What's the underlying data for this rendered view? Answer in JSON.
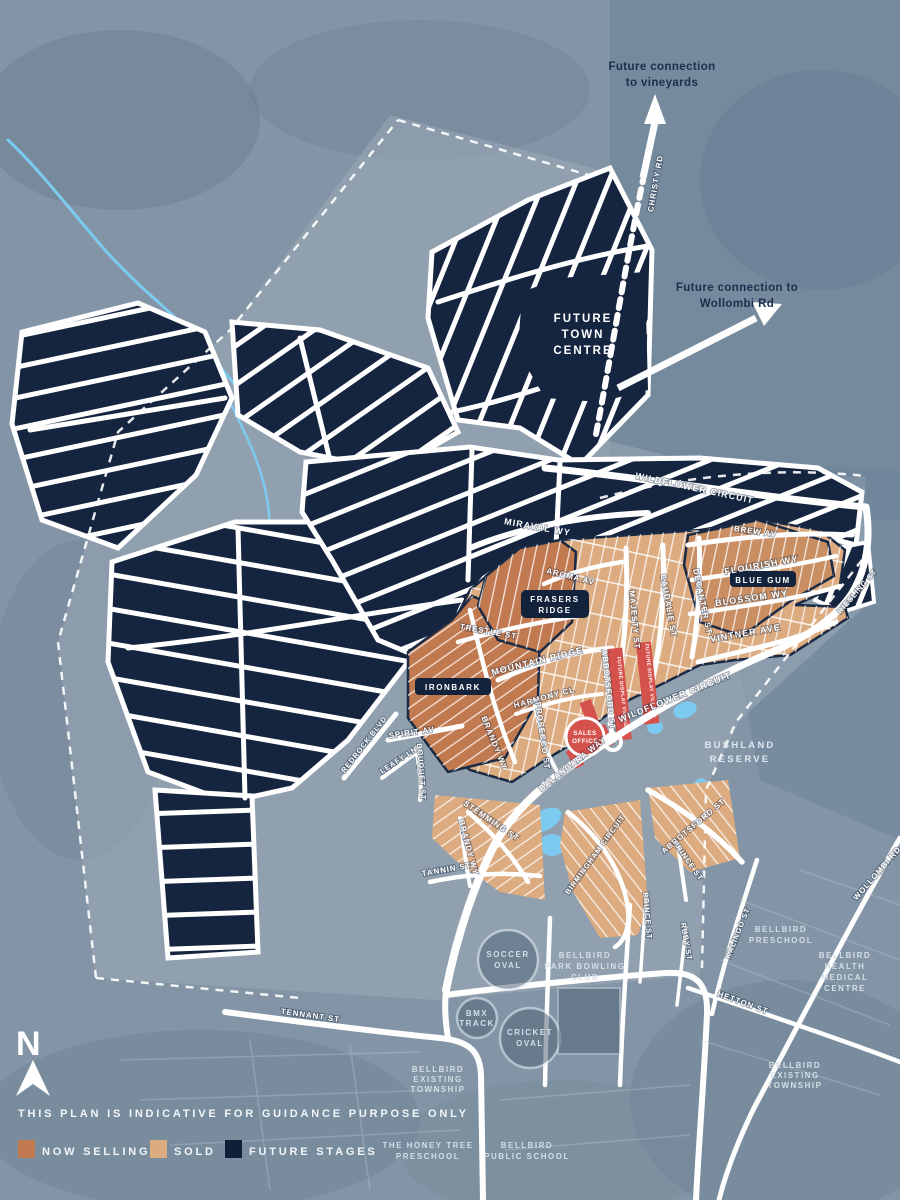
{
  "colors": {
    "now_selling": "#c1794f",
    "sold": "#dcab80",
    "future_stages": "#152540",
    "display_village_red": "#d5514b",
    "water": "#7ccaf0",
    "note_navy": "#1d2f4c"
  },
  "legend": {
    "disclaimer": "THIS PLAN IS INDICATIVE FOR GUIDANCE PURPOSE ONLY",
    "items": [
      {
        "label": "NOW SELLING",
        "color": "#c1794f"
      },
      {
        "label": "SOLD",
        "color": "#dcab80"
      },
      {
        "label": "FUTURE STAGES",
        "color": "#0f1f38"
      }
    ]
  },
  "north": {
    "label": "N"
  },
  "connections": {
    "vineyards": [
      "Future connection",
      "to vineyards"
    ],
    "wollombi": [
      "Future connection to",
      "Wollombi Rd"
    ]
  },
  "precincts": {
    "frasers_ridge": [
      "FRASERS",
      "RIDGE"
    ],
    "ironbark": "IRONBARK",
    "blue_gum": "BLUE GUM"
  },
  "markers": {
    "sales_office": [
      "SALES",
      "OFFICE"
    ],
    "display_village": "FUTURE DISPLAY VILLAGE"
  },
  "places": {
    "future_town_centre": [
      "FUTURE",
      "TOWN",
      "CENTRE"
    ],
    "bushland_reserve": [
      "BUSHLAND",
      "RESERVE"
    ],
    "soccer_oval": [
      "SOCCER",
      "OVAL"
    ],
    "bmx_track": [
      "BMX",
      "TRACK"
    ],
    "cricket_oval": [
      "CRICKET",
      "OVAL"
    ],
    "bowling_club": [
      "BELLBIRD",
      "PARK BOWLING",
      "CLUB"
    ],
    "bellbird_preschool": [
      "BELLBIRD",
      "PRESCHOOL"
    ],
    "health_centre": [
      "BELLBIRD",
      "HEALTH",
      "MEDICAL",
      "CENTRE"
    ],
    "township_sw": [
      "BELLBIRD",
      "EXISTING",
      "TOWNSHIP"
    ],
    "township_se": [
      "BELLBIRD",
      "EXISTING",
      "TOWNSHIP"
    ],
    "honey_tree_preschool": [
      "THE HONEY TREE",
      "PRESCHOOL"
    ],
    "public_school": [
      "BELLBIRD",
      "PUBLIC SCHOOL"
    ]
  },
  "streets": {
    "christy_rd": "CHRISTY RD",
    "wildflower_circuit": "WILDFLOWER CIRCUIT",
    "miraval_wy": "MIRAVAL WY",
    "brew_av": "BREW AV",
    "flourish_wy": "FLOURISH WY",
    "blossom_wy": "BLOSSOM WY",
    "vintner_ave": "VINTNER AVE",
    "decanter_st": "DECANTER ST",
    "caudalie_st": "CAUDALIE ST",
    "majesty_st": "MAJESTY ST",
    "aroma_av": "AROMA AV",
    "trestle_st": "TRESTLE ST",
    "mountain_ridge": "MOUNTAIN RIDGE",
    "harmony_cl": "HARMONY CL",
    "prosecco_st": "PROSECCO ST",
    "brandy_wy": "BRANDY WY",
    "spirit_av": "SPIRIT AV",
    "redrock_blvd": "REDROCK BLVD",
    "leafy_ln": "LEAFY LN",
    "bouquet_st": "BOUQUET ST",
    "abbotsford_st": "ABBOTSFORD ST",
    "balangara_way": "BALANGARA WAY",
    "stemming_st": "STEMMING ST",
    "tannin_st": "TANNIN ST",
    "birmingham_circuit": "BIRMINGHAM CIRCUIT",
    "prince_st": "PRINCE ST",
    "ruby_st": "RUBY ST",
    "kalingo_st": "KALINGO ST",
    "hetton_st": "HETTON ST",
    "tennant_st": "TENNANT ST",
    "wollombi_rd": "WOLLOMBI RD",
    "riesling_st": "RIESLING ST"
  }
}
